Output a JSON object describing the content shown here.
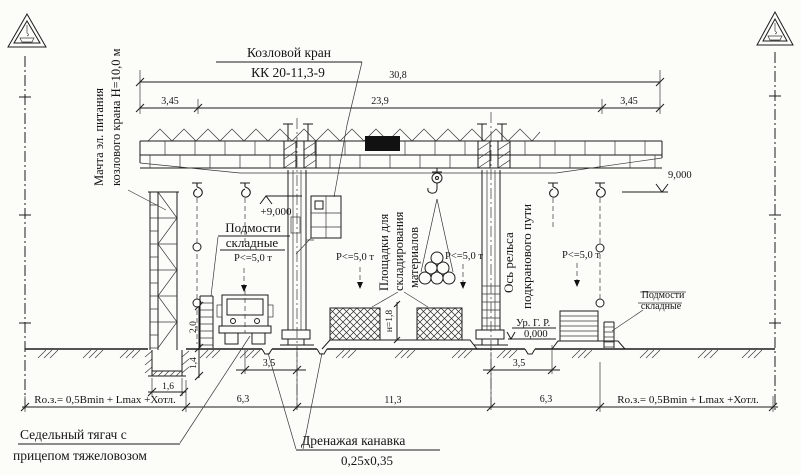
{
  "labels": {
    "crane_name": "Козловой кран",
    "crane_model": "КК 20-11,3-9",
    "mast_line1": "Мачта эл. питания",
    "mast_line2": "козлового крана Н=10,0 м",
    "platforms_line1": "Площадки для",
    "platforms_line2": "складирования",
    "platforms_line3": "материалов",
    "rail_axis_line1": "Ось рельса",
    "rail_axis_line2": "подкранового пути",
    "scaffold_line1": "Подмости",
    "scaffold_line2": "складные",
    "truck_line1": "Седельный тягач с",
    "truck_line2": "прицепом тяжеловозом",
    "drainage_line1": "Дренажая канавка",
    "drainage_size": "0,25х0,35",
    "load_limit": "Р<=5,0 т",
    "danger_zone_formula": "Rо.з.= 0,5Bmin + Lmax +Хотл."
  },
  "elevations": {
    "girder_bottom": "+9,000",
    "girder_bottom_right": "9,000",
    "rail_head_label": "Ур. Г. Р.",
    "rail_head_value": "0,000"
  },
  "dimensions": {
    "total_length": "30,8",
    "span": "23,9",
    "cantilever_left": "3,45",
    "cantilever_right": "3,45",
    "track_left": "3,5",
    "track_right": "3,5",
    "zone_left": "6,3",
    "zone_center": "11,3",
    "zone_right": "6,3",
    "foundation_width": "1,6",
    "foundation_depth": "1,4",
    "base_height": "2,0",
    "pile_height": "н=1,8"
  }
}
